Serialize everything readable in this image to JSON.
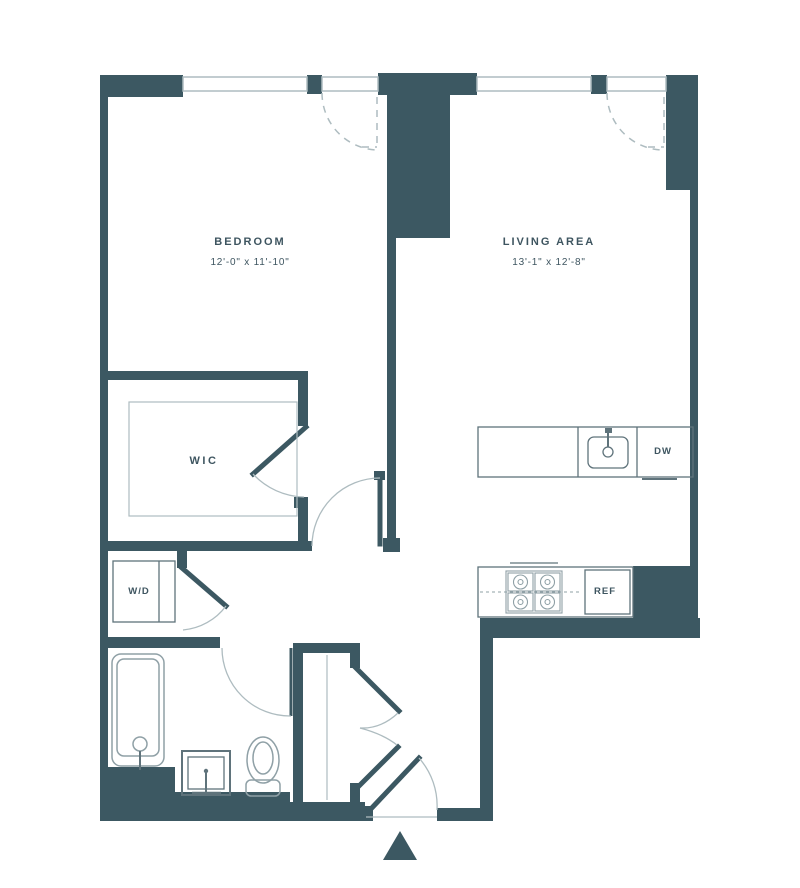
{
  "rooms": {
    "bedroom": {
      "label": "BEDROOM",
      "dimensions": "12'-0\" x 11'-10\""
    },
    "living_area": {
      "label": "LIVING AREA",
      "dimensions": "13'-1\" x 12'-8\""
    },
    "walk_in_closet": {
      "label": "WIC"
    }
  },
  "appliances": {
    "washer_dryer": {
      "label": "W/D"
    },
    "dishwasher": {
      "label": "DW"
    },
    "refrigerator": {
      "label": "REF"
    }
  },
  "colors": {
    "wall": "#3c5862",
    "line": "#5f737b",
    "light_line": "#8fa0a6",
    "faint": "#aebcc0",
    "text": "#3e5560",
    "background": "#ffffff"
  }
}
